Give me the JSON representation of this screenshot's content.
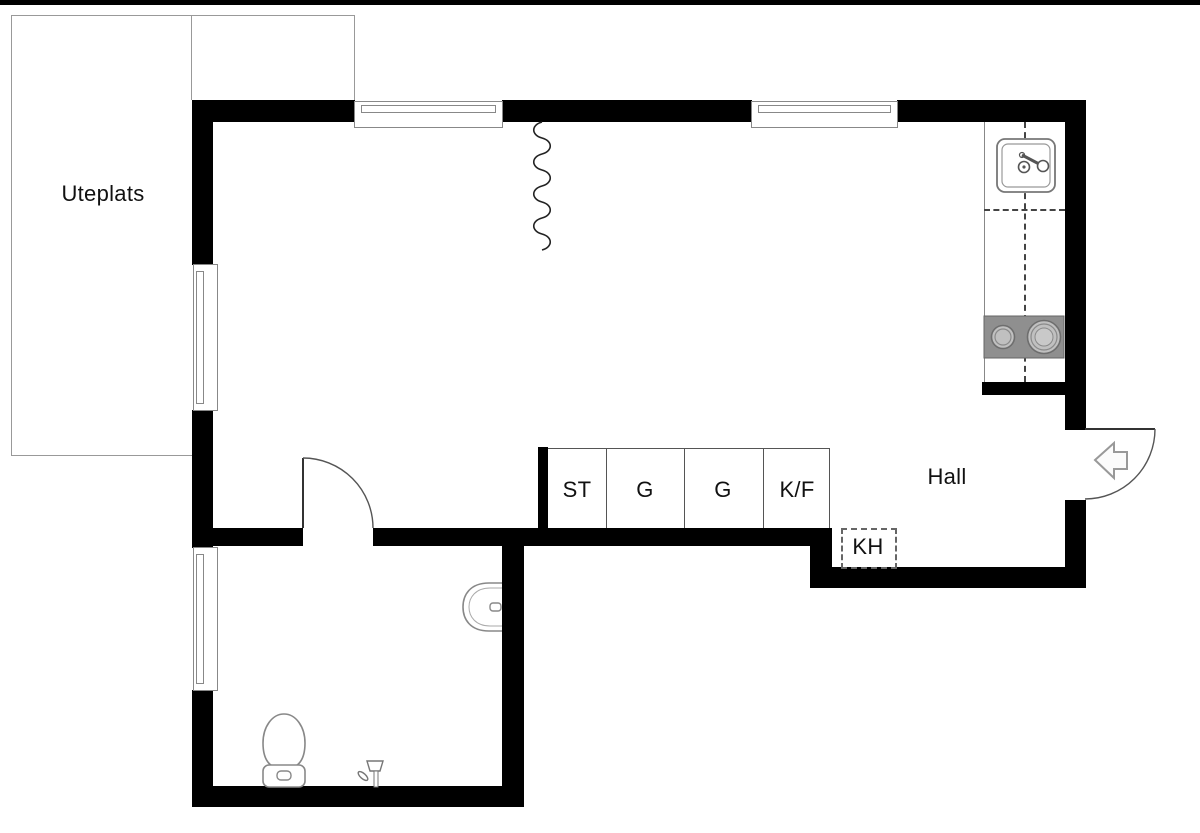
{
  "plan": {
    "type": "apartment-floor-plan",
    "room_labels": {
      "patio": "Uteplats",
      "hall": "Hall",
      "kh": "KH"
    },
    "closets": {
      "cells": [
        {
          "label": "ST"
        },
        {
          "label": "G"
        },
        {
          "label": "G"
        },
        {
          "label": "K/F"
        }
      ]
    },
    "fixtures": [
      "kitchen-sink",
      "stove-two-burners",
      "kitchen-counter",
      "bathroom-sink",
      "toilet",
      "shower-tap",
      "entry-door-swing",
      "bathroom-door-swing",
      "entry-arrow",
      "ceiling-squiggle"
    ]
  },
  "icons": {
    "entry_arrow": "left-pointing-entrance-arrow",
    "door_swing": "quarter-circle-arc",
    "window": "double-line-in-wall",
    "kitchen_sink": "rounded-square-with-tap",
    "stove": "gray-rect-with-two-burners",
    "toilet": "egg-bowl-with-tank",
    "bathroom_sink": "half-round-wall-basin",
    "shower_tap": "tap-with-lever",
    "wardrobe_zone": "dashed-rectangle"
  },
  "colors": {
    "wall": "#000000",
    "thin_line": "#999999",
    "detail_line": "#555555",
    "dashed_line": "#444444",
    "stove": "#8f8f8f",
    "burner": "#c0c0c0",
    "text": "#111111",
    "fixture": "#888888",
    "background": "#ffffff"
  }
}
